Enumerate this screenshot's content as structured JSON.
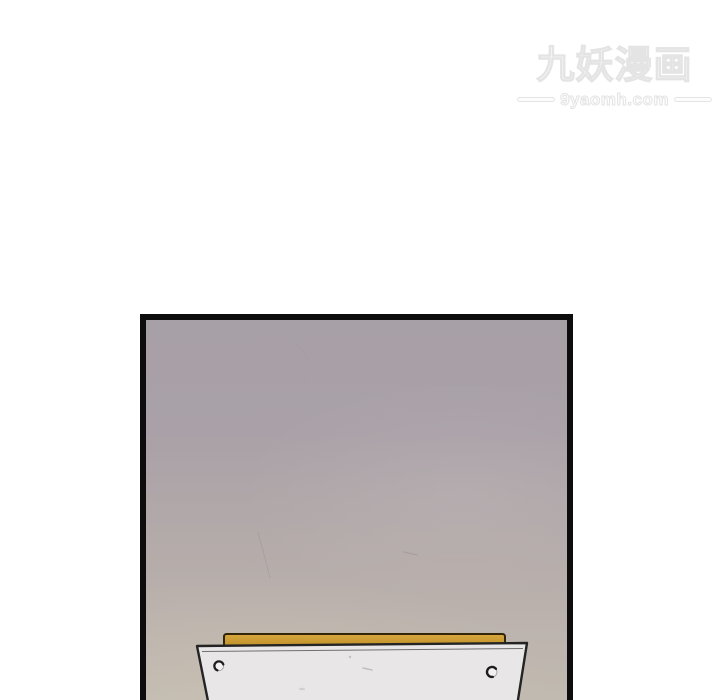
{
  "page": {
    "width": 720,
    "height": 700,
    "kind": "manhua reader page, single comic panel on white page"
  },
  "watermark": {
    "logo_text": "九妖漫画",
    "site_url": "9yaomh.com"
  },
  "comic_panel": {
    "scene": "empty mauve-grey wall above the back edge of a desk seen from a low angle",
    "elements": {
      "wall": "blank textured mauve wall with faint scratches",
      "tabletop_edge": "yellow wooden tabletop back edge strip",
      "desk_front_panel": "light grey trapezoid desk panel, cut off at bottom of image",
      "screw_left": "small hand-drawn screw head, left side",
      "screw_right": "small hand-drawn screw head, right side"
    }
  },
  "colors": {
    "page_bg": "#ffffff",
    "watermark_fill": "#fdfdfd",
    "watermark_stroke": "#e4e4e4",
    "panel_border": "#0e0d0d",
    "wall_top": "#a7a0a6",
    "wall_bottom": "#c1bab0",
    "tabletop_yellow": "#cb9c31",
    "tabletop_outline": "#33250a",
    "desk_panel_fill": "#e8e6e7",
    "desk_panel_outline": "#242424"
  }
}
